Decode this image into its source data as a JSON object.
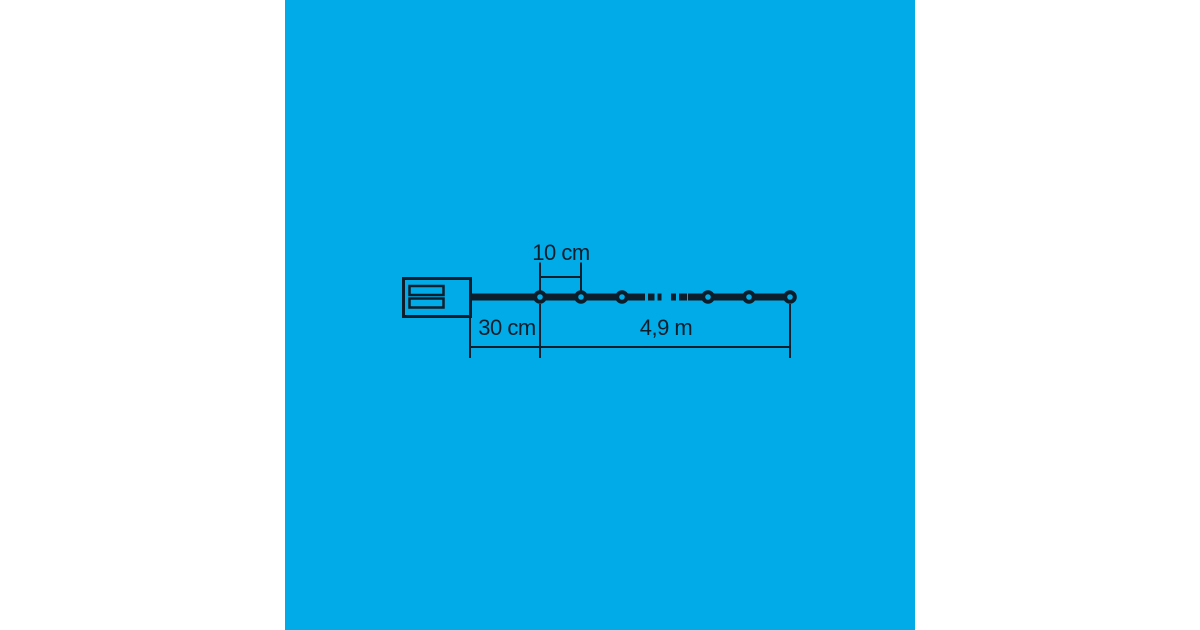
{
  "colors": {
    "page-bg": "#ffffff",
    "canvas-bg": "#00abe8",
    "ink": "#0c1e2b"
  },
  "diagram": {
    "labels": {
      "bulb_spacing": "10 cm",
      "lead_length": "30 cm",
      "total_length": "4,9 m"
    },
    "bulb_count_visible": 6
  }
}
